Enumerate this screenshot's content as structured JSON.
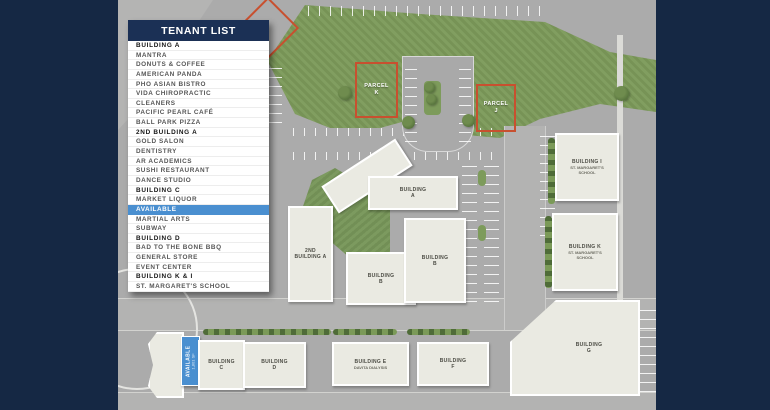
{
  "panel": {
    "title": "TENANT LIST",
    "items": [
      {
        "label": "BUILDING A",
        "style": "bold"
      },
      {
        "label": "MANTRA",
        "style": "normal"
      },
      {
        "label": "DONUTS & COFFEE",
        "style": "normal"
      },
      {
        "label": "AMERICAN PANDA",
        "style": "normal"
      },
      {
        "label": "PHO ASIAN BISTRO",
        "style": "normal"
      },
      {
        "label": "VIDA CHIROPRACTIC",
        "style": "normal"
      },
      {
        "label": "CLEANERS",
        "style": "normal"
      },
      {
        "label": "PACIFIC PEARL CAFÉ",
        "style": "normal"
      },
      {
        "label": "BALL PARK PIZZA",
        "style": "normal"
      },
      {
        "label": "2ND BUILDING A",
        "style": "bold"
      },
      {
        "label": "GOLD SALON",
        "style": "normal"
      },
      {
        "label": "DENTISTRY",
        "style": "normal"
      },
      {
        "label": "AR ACADEMICS",
        "style": "normal"
      },
      {
        "label": "SUSHI RESTAURANT",
        "style": "normal"
      },
      {
        "label": "DANCE STUDIO",
        "style": "normal"
      },
      {
        "label": "BUILDING C",
        "style": "bold"
      },
      {
        "label": "MARKET LIQUOR",
        "style": "normal"
      },
      {
        "label": "AVAILABLE",
        "style": "highlight"
      },
      {
        "label": "MARTIAL ARTS",
        "style": "normal"
      },
      {
        "label": "SUBWAY",
        "style": "normal"
      },
      {
        "label": "BUILDING D",
        "style": "bold"
      },
      {
        "label": "BAD TO THE BONE BBQ",
        "style": "normal"
      },
      {
        "label": "GENERAL STORE",
        "style": "normal"
      },
      {
        "label": "EVENT CENTER",
        "style": "normal"
      },
      {
        "label": "BUILDING K & I",
        "style": "bold"
      },
      {
        "label": "ST. MARGARET'S SCHOOL",
        "style": "normal"
      }
    ]
  },
  "map": {
    "parcels": {
      "k": {
        "line1": "PARCEL",
        "line2": "K"
      },
      "j": {
        "line1": "PARCEL",
        "line2": "J"
      }
    },
    "buildings": {
      "a": {
        "line1": "BUILDING",
        "line2": "A"
      },
      "a2": {
        "line1": "2ND",
        "line2": "BUILDING A"
      },
      "b_south": {
        "line1": "BUILDING",
        "line2": "B"
      },
      "b_east": {
        "line1": "BUILDING",
        "line2": "B"
      },
      "c": {
        "line1": "BUILDING",
        "line2": "C"
      },
      "d": {
        "line1": "BUILDING",
        "line2": "D"
      },
      "e": {
        "line1": "BUILDING E",
        "line2": "DAVITA DIALYSIS"
      },
      "f": {
        "line1": "BUILDING",
        "line2": "F"
      },
      "g": {
        "line1": "BUILDING",
        "line2": "G"
      },
      "i": {
        "line1": "BUILDING I",
        "line2": "ST. MARGARET'S SCHOOL"
      },
      "k": {
        "line1": "BUILDING K",
        "line2": "ST. MARGARET'S SCHOOL"
      }
    },
    "available_unit": {
      "line1": "AVAILABLE",
      "line2": "1,801 SF"
    },
    "colors": {
      "frame_navy": "#152844",
      "header_navy": "#1b3055",
      "parcel_red": "#c8502f",
      "available_blue": "#4a8fd0",
      "grass_green": "#7d9b5b",
      "building_fill": "#eaeae2",
      "road_gray": "#ababab"
    }
  }
}
